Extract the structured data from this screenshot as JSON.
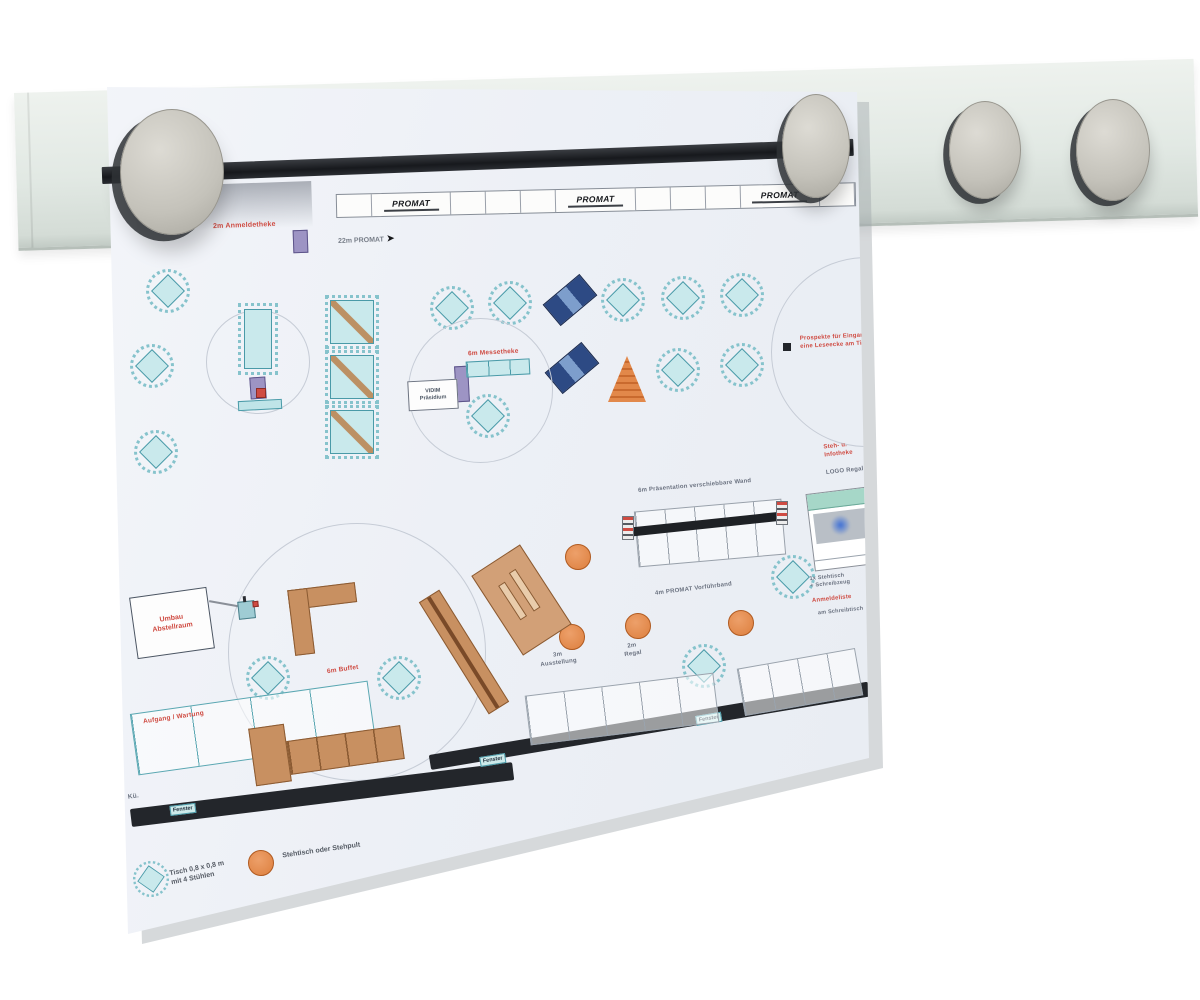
{
  "colors": {
    "paper_bg": "#f2f4f8",
    "rail": "#e4eae5",
    "magnet": "#c7c5bd",
    "black_bar": "#1e2125",
    "table_fill": "#c9e9ec",
    "table_border": "#4a9aa8",
    "orange": "#e2884a",
    "navy": "#2d4a84",
    "wood": "#c89061",
    "red": "#cf4b42",
    "gray_text": "#6b7280",
    "purple": "#9d94c4"
  },
  "rail": {
    "magnet_count": 4,
    "magnets": [
      {
        "x": 172,
        "y": 172,
        "rx": 52,
        "ry": 63
      },
      {
        "x": 816,
        "y": 146,
        "rx": 34,
        "ry": 52
      },
      {
        "x": 985,
        "y": 150,
        "rx": 36,
        "ry": 49
      },
      {
        "x": 1113,
        "y": 150,
        "rx": 37,
        "ry": 51
      }
    ]
  },
  "paper": {
    "banner": {
      "logo_text": "PROMAT",
      "pattern": [
        "s",
        "logo",
        "s",
        "s",
        "s",
        "logo",
        "s",
        "s",
        "s",
        "logo",
        "s"
      ]
    },
    "arrow_note": "22m PROMAT",
    "windows": [
      "Fenster",
      "Fenster",
      "Fenster"
    ],
    "legend": {
      "table_text": "Tisch 0,8 x 0,8 m\nmit 4 Stühlen",
      "stand_text": "Stehtisch oder Stehpult"
    },
    "vtable": {
      "x": 244,
      "y": 309,
      "w": 28,
      "h": 60
    },
    "sideboard": {
      "x": 238,
      "y": 400,
      "w": 44,
      "h": 10,
      "rot": -3
    },
    "buffet_bar": {
      "x": 466,
      "y": 360,
      "w": 64,
      "h": 16,
      "rot": -3,
      "n": 3
    },
    "cone": {
      "x": 608,
      "y": 356,
      "w": 38,
      "h": 46
    },
    "pwall": {
      "x": 636,
      "y": 505,
      "w": 148,
      "h": 56,
      "rot": -5,
      "n": 5,
      "bar": {
        "x": 626,
        "y": 528,
        "w": 160,
        "h": 9,
        "rot": -6
      },
      "caps": [
        [
          622,
          516
        ],
        [
          776,
          501
        ]
      ]
    },
    "logo_box": {
      "x": 810,
      "y": 490,
      "w": 62,
      "h": 78,
      "rot": -7
    },
    "callout": {
      "x": 133,
      "y": 592,
      "w": 78,
      "h": 62,
      "rot": -8,
      "text": "Umbau\nAbstellraum"
    },
    "callout_line": {
      "x": 209,
      "y": 603,
      "w": 33,
      "rot": 10
    },
    "gadget": {
      "x": 238,
      "y": 596,
      "w": 17,
      "h": 26,
      "rot": -6
    },
    "label_box": {
      "x": 408,
      "y": 380,
      "w": 50,
      "h": 30,
      "rot": -3,
      "text": "VIDIM\nPräsidium"
    },
    "black_dot": {
      "x": 783,
      "y": 343,
      "s": 8
    },
    "annotations": [
      {
        "text": "2m Anmeldetheke",
        "x": 213,
        "y": 221,
        "rot": -2,
        "size": 7,
        "color": "red"
      },
      {
        "text": "6m Messetheke",
        "x": 468,
        "y": 349,
        "rot": -3,
        "size": 6.5,
        "color": "red"
      },
      {
        "text": "Prospekte für Eingang\neine Leseecke am Tisch",
        "x": 800,
        "y": 334,
        "rot": -3,
        "size": 6,
        "color": "red"
      },
      {
        "text": "Steh- u.\nInfotheke",
        "x": 824,
        "y": 443,
        "rot": -6,
        "size": 6,
        "color": "red"
      },
      {
        "text": "Anmeldeliste",
        "x": 812,
        "y": 596,
        "rot": -6,
        "size": 6,
        "color": "red"
      },
      {
        "text": "Aufgang / Wartung",
        "x": 143,
        "y": 714,
        "rot": -8,
        "size": 6.5,
        "color": "red"
      },
      {
        "text": "6m Buffet",
        "x": 327,
        "y": 666,
        "rot": -8,
        "size": 6.5,
        "color": "red"
      },
      {
        "text": "6m Präsentation verschiebbare Wand",
        "x": 638,
        "y": 483,
        "rot": -5,
        "size": 6,
        "color": "gray"
      },
      {
        "text": "4m PROMAT Vorführband",
        "x": 655,
        "y": 586,
        "rot": -7,
        "size": 6,
        "color": "gray"
      },
      {
        "text": "3m\nAusstellung",
        "x": 540,
        "y": 652,
        "rot": -7,
        "size": 6,
        "color": "gray",
        "align": "center"
      },
      {
        "text": "2m\nRegal",
        "x": 624,
        "y": 643,
        "rot": -8,
        "size": 6,
        "color": "gray",
        "align": "center"
      },
      {
        "text": "LOGO Regal",
        "x": 826,
        "y": 468,
        "rot": -6,
        "size": 6,
        "color": "gray"
      },
      {
        "text": "1x Stehtisch\n+ Schreibzeug",
        "x": 810,
        "y": 574,
        "rot": -6,
        "size": 5.5,
        "color": "gray"
      },
      {
        "text": "am Schreibtisch",
        "x": 818,
        "y": 608,
        "rot": -6,
        "size": 5.5,
        "color": "gray"
      },
      {
        "text": "Kü.",
        "x": 128,
        "y": 793,
        "rot": -8,
        "size": 6.5,
        "color": "gray"
      }
    ]
  },
  "furniture": {
    "diamond_tables": [
      [
        168,
        291
      ],
      [
        152,
        366
      ],
      [
        156,
        452
      ],
      [
        452,
        308
      ],
      [
        510,
        303
      ],
      [
        623,
        300
      ],
      [
        683,
        298
      ],
      [
        742,
        295
      ],
      [
        678,
        370
      ],
      [
        742,
        365
      ],
      [
        488,
        416
      ],
      [
        793,
        577
      ],
      [
        704,
        666
      ],
      [
        268,
        678
      ],
      [
        399,
        678
      ]
    ],
    "square_tables": [
      [
        352,
        322
      ],
      [
        352,
        377
      ],
      [
        352,
        432
      ]
    ],
    "stand_tables": [
      [
        578,
        557
      ],
      [
        572,
        637
      ],
      [
        638,
        626
      ],
      [
        741,
        623
      ]
    ],
    "blue_stands": [
      [
        570,
        300,
        -40
      ],
      [
        572,
        368,
        -40
      ]
    ],
    "purple_blocks": [
      [
        293,
        230,
        15,
        23,
        -2
      ],
      [
        250,
        377,
        16,
        22,
        -4
      ],
      [
        455,
        366,
        14,
        36,
        -3
      ]
    ],
    "red_dots": [
      [
        256,
        388,
        10
      ]
    ],
    "circles": [
      [
        258,
        362,
        104
      ],
      [
        480,
        390,
        145
      ],
      [
        357,
        652,
        258
      ],
      [
        866,
        352,
        190
      ]
    ],
    "walls": [
      [
        131,
        809,
        385,
        18,
        -7
      ],
      [
        430,
        755,
        445,
        15,
        -9.5
      ]
    ],
    "window_labels": [
      [
        170,
        806,
        -7
      ],
      [
        480,
        757,
        -9
      ],
      [
        696,
        716,
        -9.5
      ]
    ],
    "counters": [
      [
        133,
        697,
        240,
        62,
        -8,
        "teal",
        4
      ],
      [
        527,
        684,
        190,
        50,
        -7,
        "gray",
        5
      ],
      [
        740,
        658,
        120,
        48,
        -10,
        "gray",
        4
      ]
    ],
    "wood": [
      [
        464,
        652,
        132,
        24,
        58,
        "bench"
      ],
      [
        521,
        600,
        95,
        58,
        57,
        "table"
      ],
      [
        270,
        755,
        36,
        58,
        -8,
        "cab"
      ],
      [
        345,
        750,
        115,
        34,
        -8,
        "row"
      ]
    ],
    "lshape": [
      291,
      586,
      68,
      66,
      -7
    ]
  }
}
